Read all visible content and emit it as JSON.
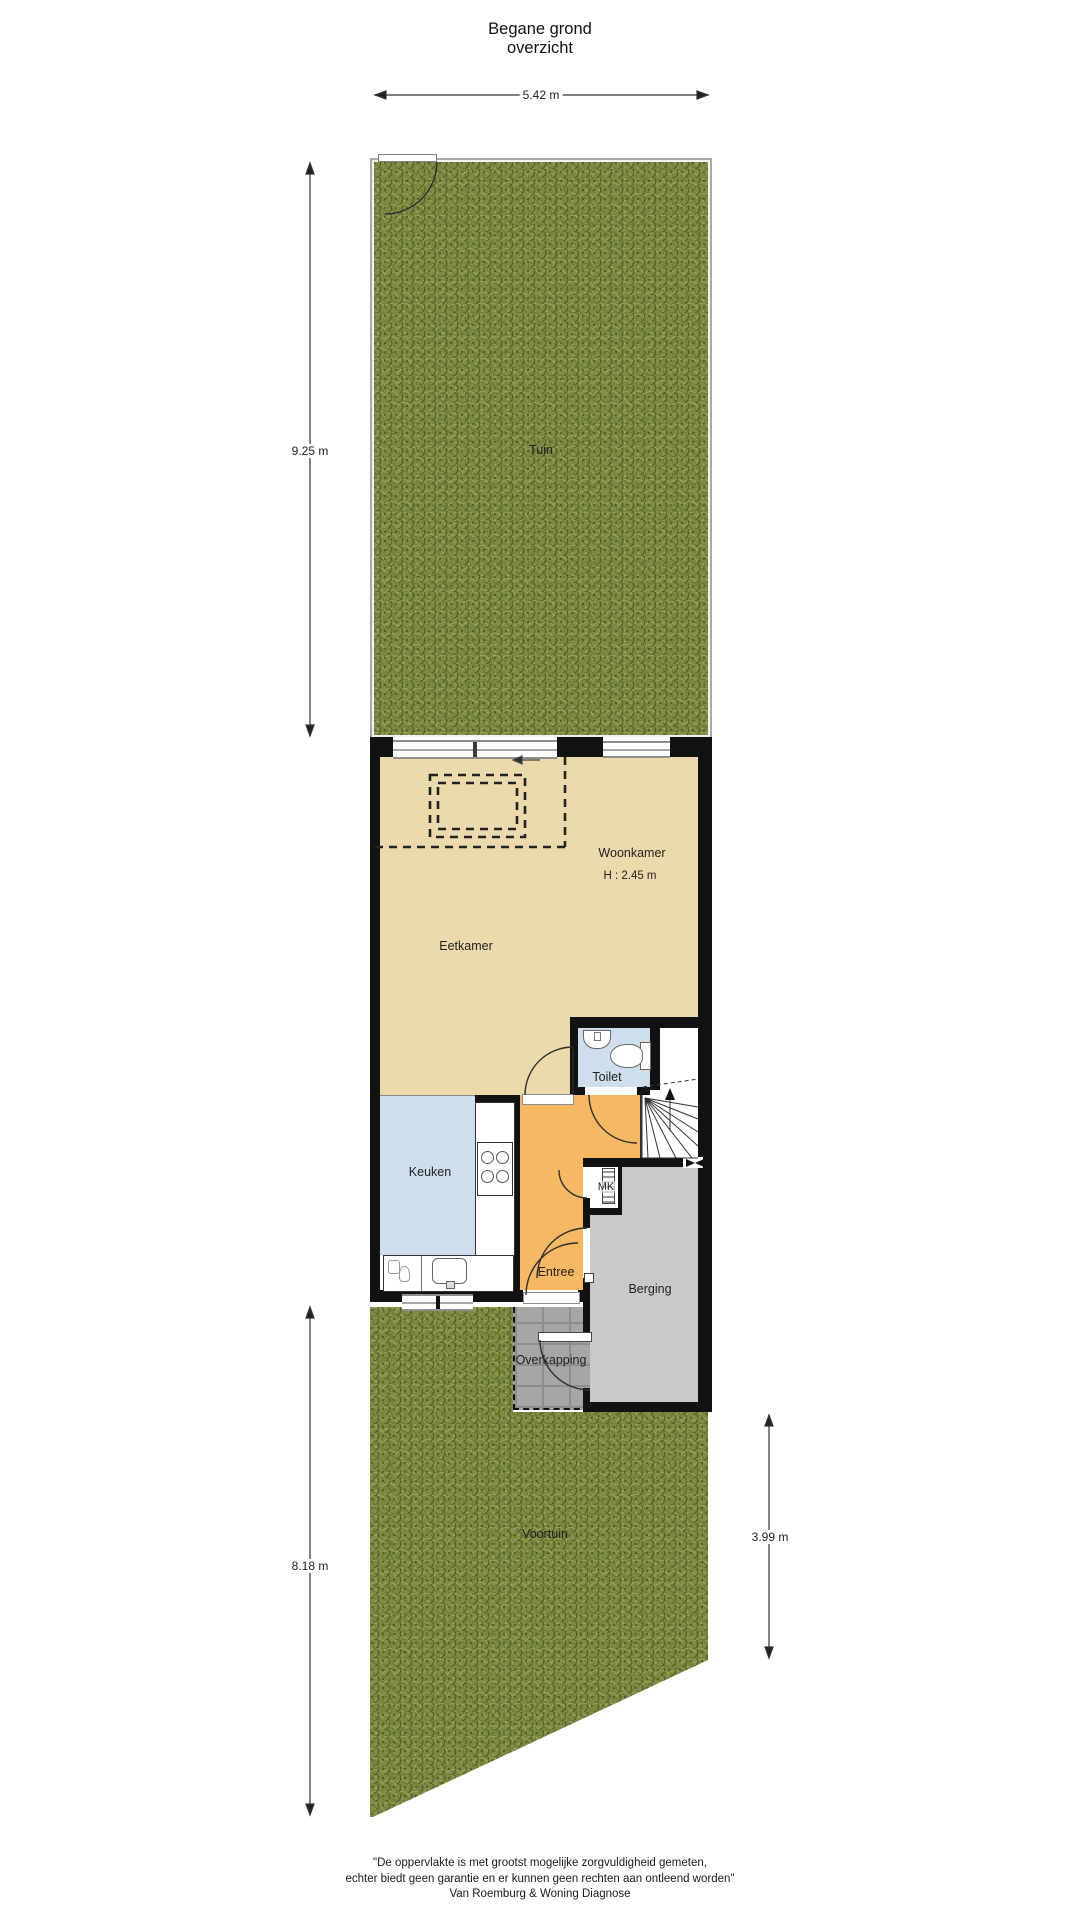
{
  "title": {
    "line1": "Begane grond",
    "line2": "overzicht"
  },
  "dimensions": {
    "garden_width": "5.42 m",
    "garden_depth": "9.25 m",
    "front_garden_depth": "8.18 m",
    "front_garden_right_depth": "3.99 m"
  },
  "rooms": {
    "tuin": "Tuin",
    "woonkamer": "Woonkamer",
    "woonkamer_height": "H : 2.45 m",
    "eetkamer": "Eetkamer",
    "toilet": "Toilet",
    "keuken": "Keuken",
    "mk": "MK",
    "entree": "Entree",
    "berging": "Berging",
    "overkapping": "Overkapping",
    "voortuin": "Voortuin"
  },
  "footer": {
    "line1": "\"De oppervlakte is met grootst mogelijke zorgvuldigheid gemeten,",
    "line2": "echter biedt geen garantie en er kunnen geen rechten aan ontleend worden\"",
    "line3": "Van Roemburg & Woning Diagnose"
  },
  "colors": {
    "wall": "#121212",
    "living_floor": "#ecd9ac",
    "kitchen_floor": "#cfdeec",
    "toilet_floor": "#cfdeec",
    "hall_floor": "#f6b863",
    "storage_floor": "#c9c9c9",
    "grass": "#7e8c44",
    "paving": "#a6a6a6"
  },
  "icons": {
    "stairs_up_arrow": "▲",
    "vent_valve": "⋈"
  }
}
